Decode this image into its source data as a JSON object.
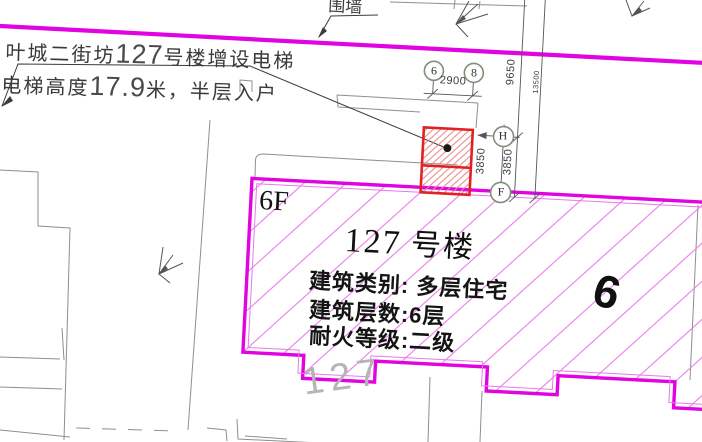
{
  "annotation": {
    "line1_prefix": "叶城二街坊",
    "line1_number": "127",
    "line1_suffix": "号楼增设电梯",
    "line2_prefix": "电梯高度",
    "line2_number": "17.9",
    "line2_suffix": "米，半层入户"
  },
  "fence_label": "围墙",
  "grid_bubbles": {
    "left": "6",
    "right": "8",
    "upper": "H",
    "lower": "F"
  },
  "dimensions": {
    "elevator_width": "2900",
    "long_left": "9650",
    "long_right": "13500",
    "segment_left": "3850",
    "segment_right": "3850"
  },
  "building": {
    "floors_badge": "6F",
    "title_number": "127",
    "title_suffix": " 号楼",
    "info_type": "建筑类别: 多层住宅",
    "info_floors": "建筑层数:6层",
    "info_fire": "耐火等级:二级",
    "unit_mark": "6",
    "ground_number": "127"
  },
  "colors": {
    "boundary_magenta": "#e103e1",
    "hatch_magenta": "#ea79ea",
    "elevator_red": "#e02222",
    "elevator_hatch_red": "#ec8585",
    "neighbor_gray": "#8f8f8f",
    "dimension_gray": "#555555",
    "grid_bubble_olive": "#7f8f7a",
    "ghost_text_gray": "#b5b5b5"
  }
}
